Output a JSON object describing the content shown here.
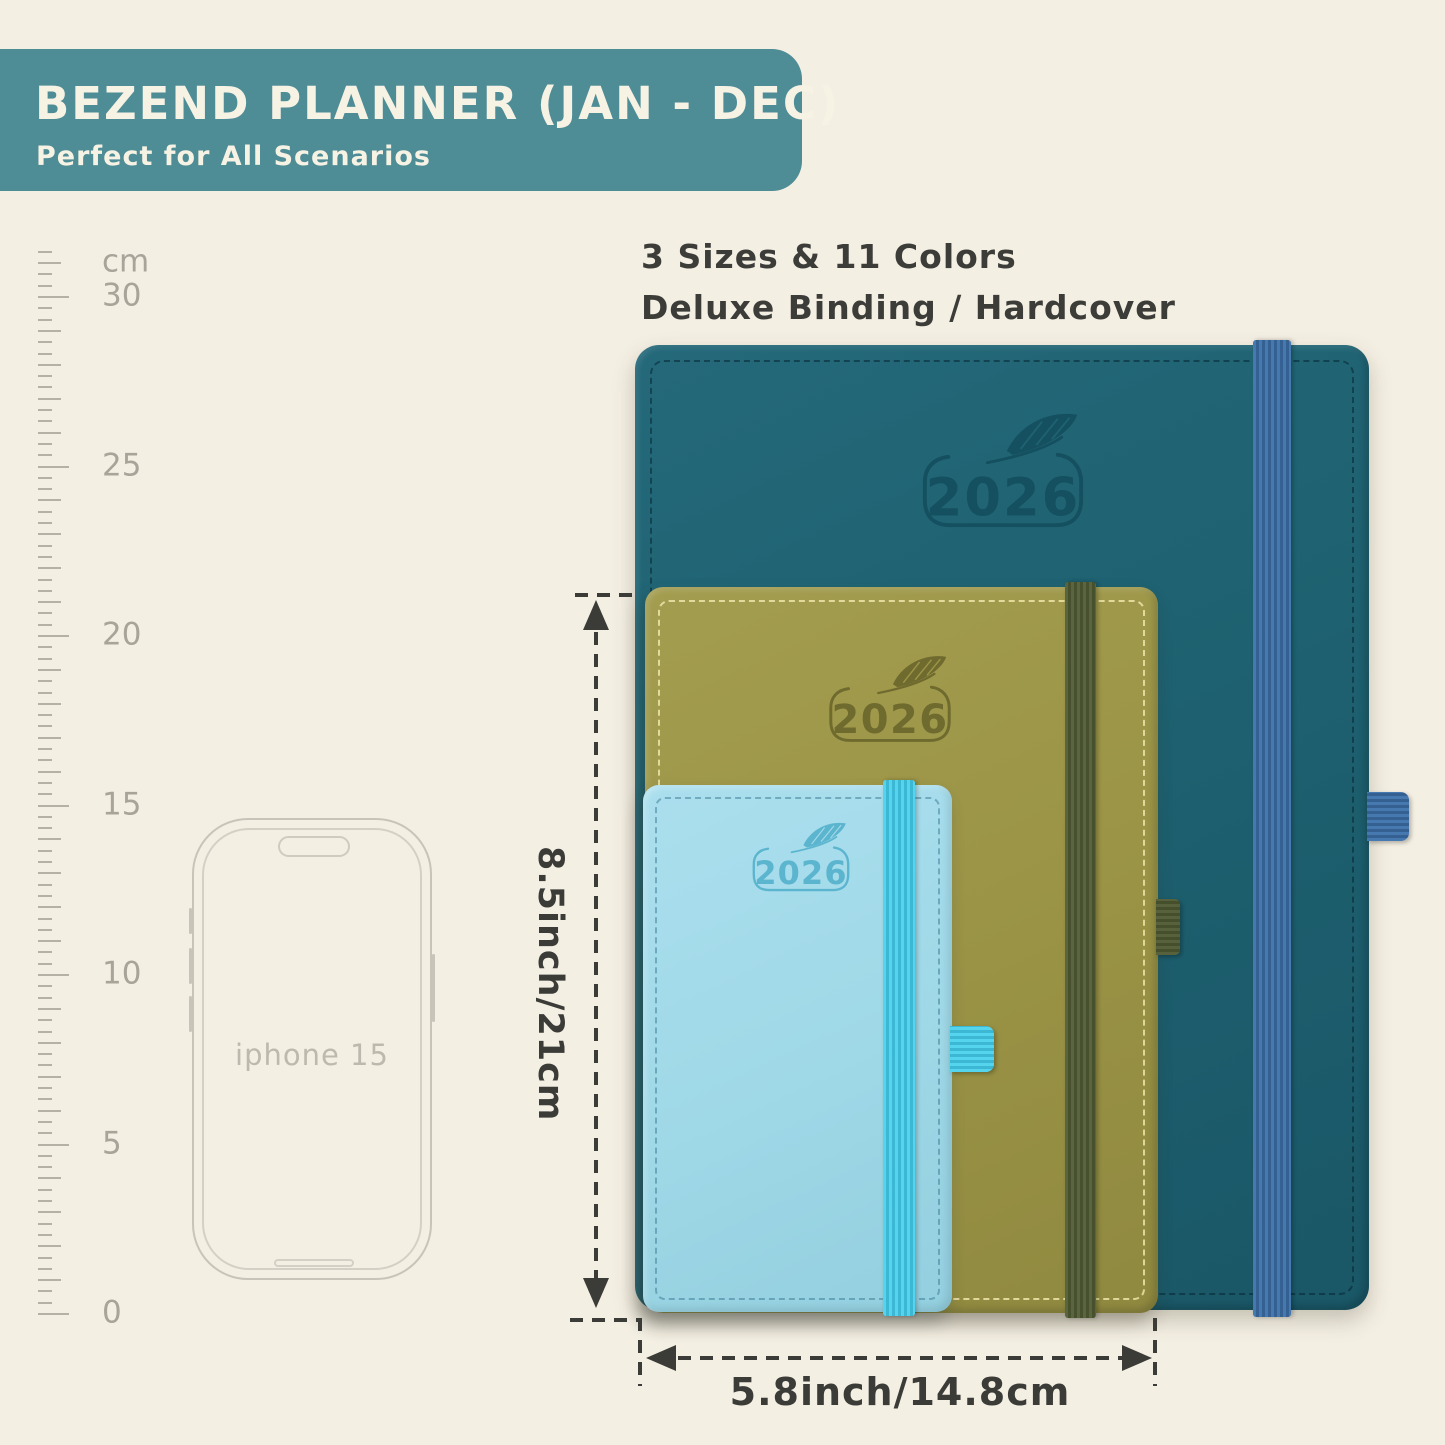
{
  "banner": {
    "title": "BEZEND PLANNER (JAN - DEC)",
    "subtitle": "Perfect for All Scenarios",
    "bg_color": "#4e8c96",
    "text_color": "#f6f2e4"
  },
  "features": {
    "line1": "3 Sizes & 11 Colors",
    "line2": "Deluxe Binding / Hardcover"
  },
  "ruler": {
    "unit_label": "cm",
    "zero_y": 1313,
    "px_per_cm": 33.9,
    "max_cm": 31.3,
    "tick_color": "#b6b1a5",
    "label_color": "#a9a49a",
    "labels": [
      {
        "cm": 31,
        "text": "cm"
      },
      {
        "cm": 30,
        "text": "30"
      },
      {
        "cm": 25,
        "text": "25"
      },
      {
        "cm": 20,
        "text": "20"
      },
      {
        "cm": 15,
        "text": "15"
      },
      {
        "cm": 10,
        "text": "10"
      },
      {
        "cm": 5,
        "text": "5"
      },
      {
        "cm": 0,
        "text": "0"
      }
    ]
  },
  "phone": {
    "label": "iphone 15"
  },
  "planners": [
    {
      "name": "large",
      "year": "2026",
      "cover_color": "#1e6170",
      "band_color": "#4173a9",
      "stitch_color": "#0e3644"
    },
    {
      "name": "medium",
      "year": "2026",
      "cover_color": "#9b9446",
      "band_color": "#57623c",
      "stitch_color": "#eee4aa"
    },
    {
      "name": "small",
      "year": "2026",
      "cover_color": "#9fd8e7",
      "band_color": "#4ecfe9",
      "stitch_color": "#2d6e87"
    }
  ],
  "dimensions": {
    "height_label": "8.5inch/21cm",
    "width_label": "5.8inch/14.8cm"
  }
}
